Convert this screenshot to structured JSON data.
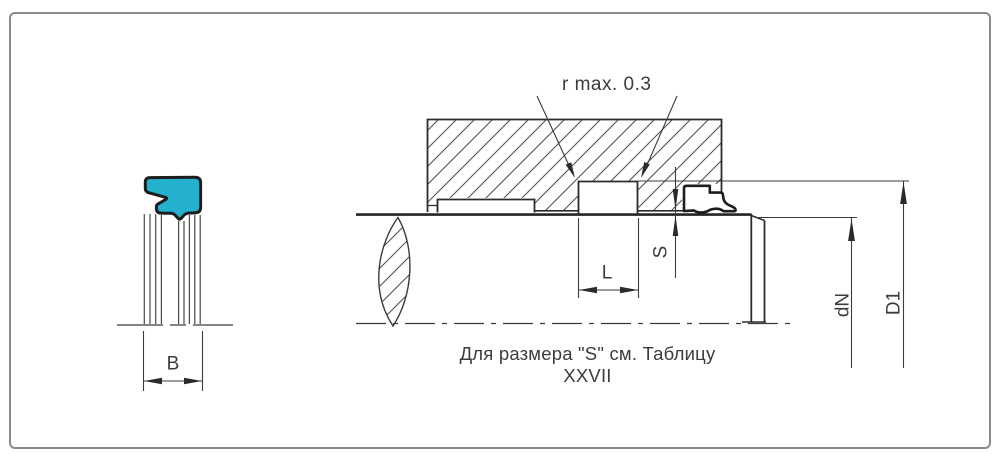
{
  "drawing": {
    "caption": "Для размера \"S\" см. Таблицу XXVII",
    "radius_note": "r max. 0.3",
    "labels": {
      "B": "B",
      "L": "L",
      "S": "S",
      "dN": "dN",
      "D1": "D1"
    },
    "colors": {
      "seal_fill": "#23b1cd",
      "line": "#3c3c3c",
      "outline": "#1d1d1d",
      "border": "#8a8a8a"
    }
  }
}
